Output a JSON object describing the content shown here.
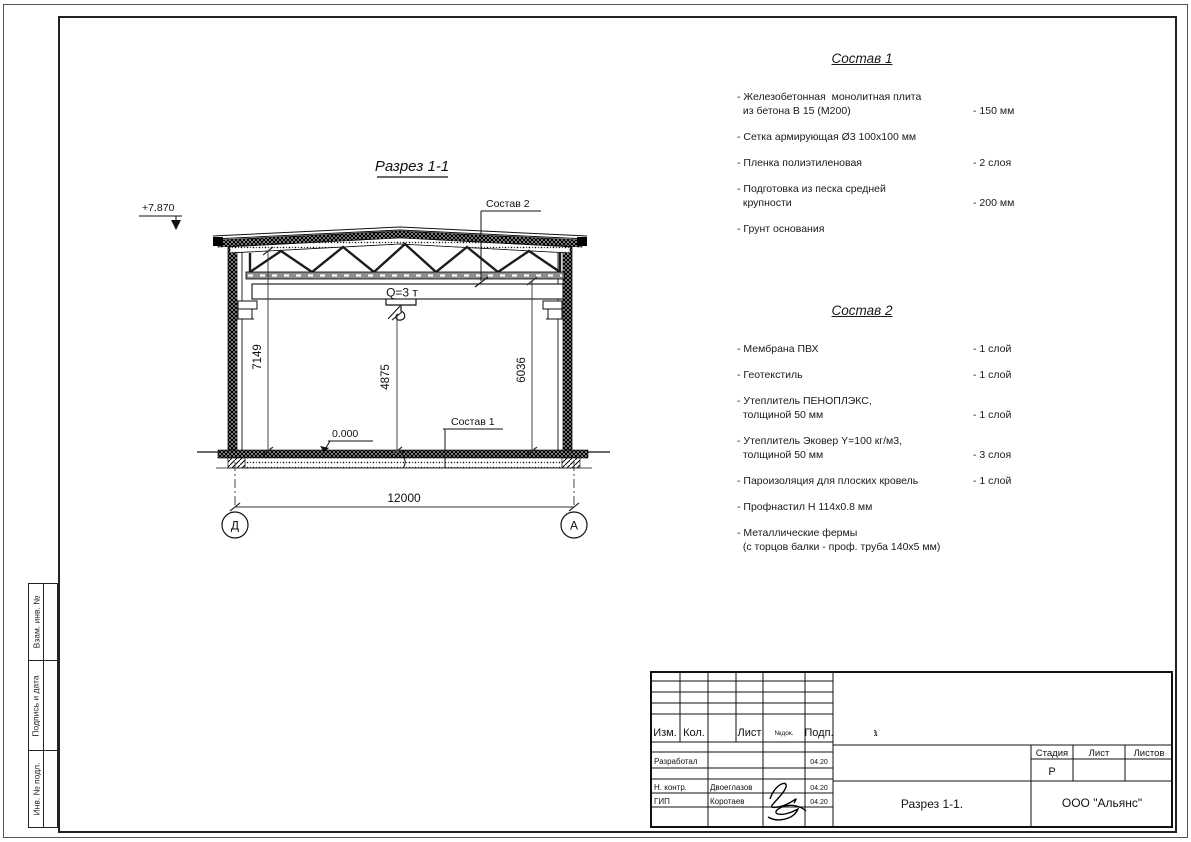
{
  "drawing": {
    "title": "Разрез 1-1",
    "elevation_mark": "+7.870",
    "level_mark": "0.000",
    "crane_capacity": "Q=3 т",
    "dim_height_left": "7149",
    "dim_height_center": "4875",
    "dim_height_right": "6036",
    "dim_span": "12000",
    "axis_left": "Д",
    "axis_right": "А",
    "callout_1": "Состав 1",
    "callout_2": "Состав 2"
  },
  "lists": {
    "sostav1": {
      "title": "Состав 1",
      "items": [
        {
          "name": "- Железобетонная  монолитная плита\n  из бетона В 15 (М200)",
          "value": "- 150 мм"
        },
        {
          "name": "- Сетка армирующая Ø3 100х100 мм",
          "value": ""
        },
        {
          "name": "- Пленка полиэтиленовая",
          "value": "- 2 слоя"
        },
        {
          "name": "- Подготовка из песка средней\n  крупности",
          "value": "- 200 мм"
        },
        {
          "name": "- Грунт основания",
          "value": ""
        }
      ]
    },
    "sostav2": {
      "title": "Состав 2",
      "items": [
        {
          "name": "- Мембрана ПВХ",
          "value": "- 1 слой"
        },
        {
          "name": "- Геотекстиль",
          "value": "- 1 слой"
        },
        {
          "name": "- Утеплитель ПЕНОПЛЭКС,\n  толщиной 50 мм",
          "value": "- 1 слой"
        },
        {
          "name": "- Утеплитель Эковер Y=100 кг/м3,\n  толщиной 50 мм",
          "value": "- 3 слоя"
        },
        {
          "name": "- Пароизоляция для плоских кровель",
          "value": "- 1 слой"
        },
        {
          "name": "- Профнастил Н 114х0.8 мм",
          "value": ""
        },
        {
          "name": "- Металлические фермы\n  (с торцов балки - проф. труба 140х5 мм)",
          "value": ""
        }
      ]
    }
  },
  "stamps": [
    "Взам. инв. №",
    "Подпись и дата",
    "Инв. № подл."
  ],
  "titleblock": {
    "columns": [
      "Изм.",
      "Кол.",
      "Лист",
      "№док.",
      "Подп.",
      "Дата"
    ],
    "stage_header": [
      "Стадия",
      "Лист",
      "Листов"
    ],
    "rows": [
      {
        "role": "Разработал",
        "name": "",
        "date": "04.20"
      },
      {
        "role": "Н. контр.",
        "name": "Двоеглазов",
        "date": "04.20"
      },
      {
        "role": "ГИП",
        "name": "Коротаев",
        "date": "04.20"
      }
    ],
    "stage": "Р",
    "doc_name": "Разрез 1-1.",
    "company": "ООО \"Альянс\""
  }
}
